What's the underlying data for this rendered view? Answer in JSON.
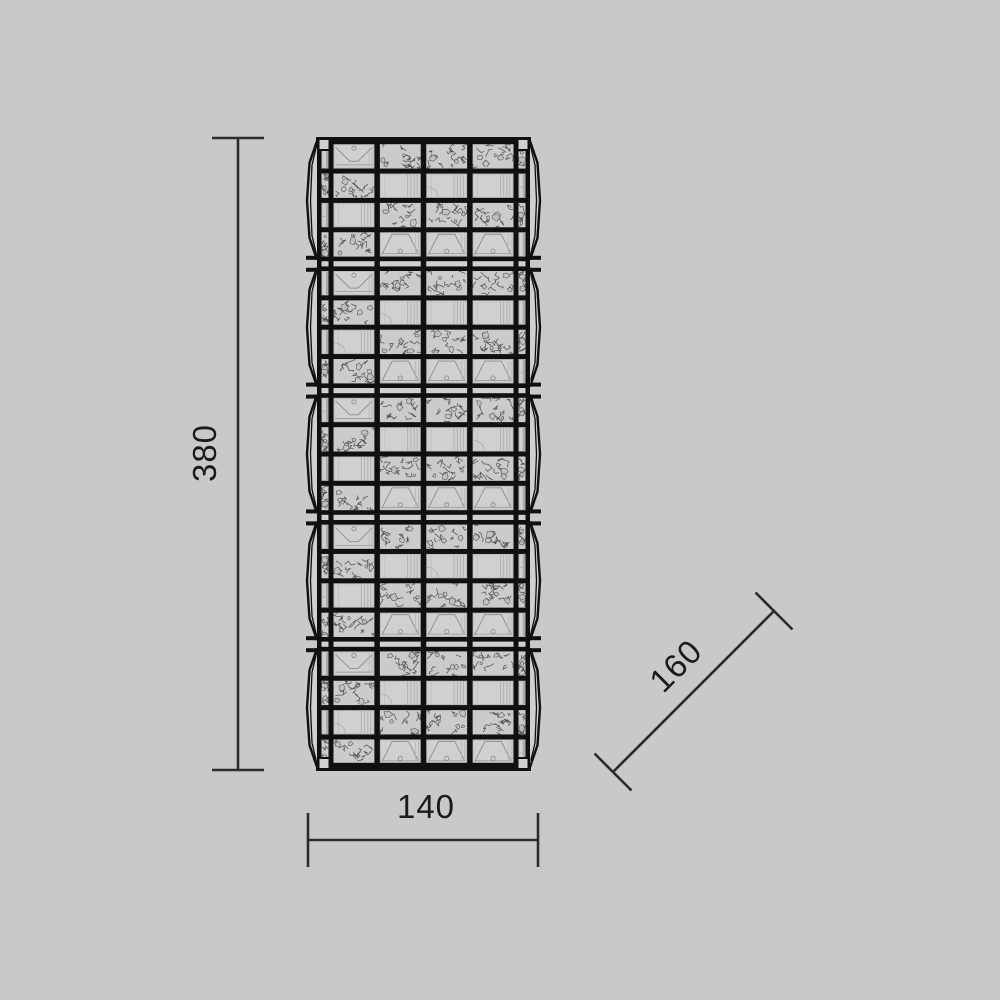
{
  "drawing": {
    "type": "product-dimension-elevation",
    "subject": "crystal-cube-grid-lamp",
    "colors": {
      "background": "#c9c9c9",
      "frame": "#101010",
      "face": "#d0d0d0",
      "crackle_fill": "#cbcbcb",
      "crackle_line": "#4a4a4a",
      "faint_line": "#aaaaaa",
      "detail_line": "#8e8e8e",
      "dimension_line": "#2b2b2b",
      "text": "#1b1b1b"
    }
  },
  "fixture": {
    "modules": 5,
    "rows_per_module": 4,
    "columns": 4,
    "pattern_rows": [
      [
        "funnel_down",
        "crackle",
        "crackle",
        "crackle"
      ],
      [
        "crackle",
        "plain",
        "plain",
        "plain"
      ],
      [
        "plain",
        "crackle",
        "crackle",
        "crackle"
      ],
      [
        "crackle",
        "funnel_up",
        "funnel_up",
        "funnel_up"
      ]
    ],
    "strip_left_rows": [
      "plain",
      "crackle",
      "plain",
      "crackle"
    ],
    "strip_right_rows": [
      "crackle",
      "plain",
      "crackle",
      "plain"
    ],
    "geometry": {
      "face_left": 317,
      "face_right": 530,
      "top": 137,
      "bottom": 771,
      "bulge": 10,
      "edge_bar": 4.5,
      "strip_width": 7,
      "strip_bar": 5,
      "col_bar": 5.5,
      "boundary_bar": 4.6,
      "boundary_gap": 5.2,
      "row_bar": 5
    }
  },
  "dimensions": {
    "height": {
      "label": "380",
      "line": {
        "x": 238,
        "y1": 138,
        "y2": 770
      },
      "ticks": [
        {
          "x1": 212,
          "x2": 264,
          "y": 138
        },
        {
          "x1": 212,
          "x2": 264,
          "y": 770
        }
      ]
    },
    "width": {
      "label": "140",
      "line": {
        "y": 840,
        "x1": 308,
        "x2": 538
      },
      "ticks": [
        {
          "y1": 813,
          "y2": 867,
          "x": 308
        },
        {
          "y1": 813,
          "y2": 867,
          "x": 538
        }
      ]
    },
    "depth": {
      "label": "160",
      "angle_deg": -45,
      "line": {
        "x1": 613,
        "y1": 772,
        "x2": 774,
        "y2": 611
      },
      "tick_half_len": 18.5
    }
  }
}
